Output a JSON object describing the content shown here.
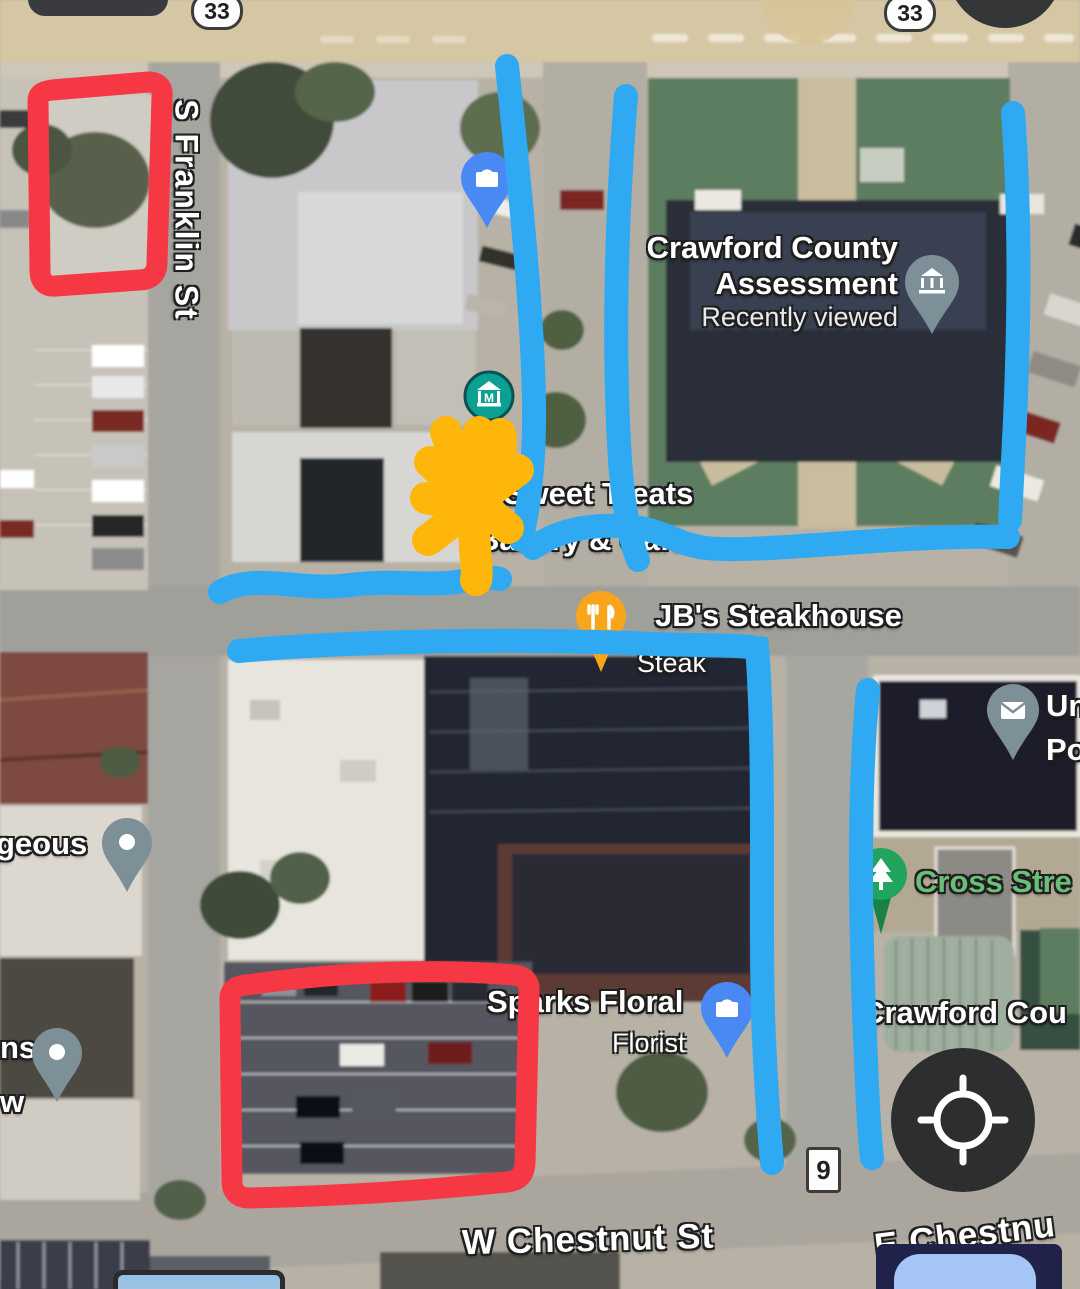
{
  "map_type": "satellite",
  "streets": {
    "franklin": "S Franklin St",
    "west_chestnut": "W Chestnut St",
    "east_chestnut": "E Chestnu"
  },
  "route_shields": {
    "left": "33",
    "right": "33",
    "bottom": "9"
  },
  "places": {
    "assessment": {
      "name_line1": "Crawford County",
      "name_line2": "Assessment",
      "status": "Recently viewed",
      "icon": "government-pin"
    },
    "bakery": {
      "name_line1": "ty's Sweet Treats",
      "name_line2": "Bakery & Cafe",
      "icon": "museum-pin"
    },
    "steakhouse": {
      "name": "JB's Steakhouse",
      "category": "Steak",
      "icon": "restaurant-pin"
    },
    "floral": {
      "name": "Sparks Floral",
      "category": "Florist",
      "icon": "shopping-bag-pin"
    },
    "cross_street": {
      "name": "Cross Stre",
      "icon": "tree-pin"
    },
    "crawford_partial": {
      "name": "Crawford Cou"
    },
    "post_office": {
      "name_line1": "Un",
      "name_line2": "Po",
      "icon": "mail-pin"
    },
    "gorgeous_partial": {
      "name": "geous",
      "icon": "place-pin"
    },
    "ns_partial": {
      "name_line1": "ns",
      "name_line2": "w",
      "icon": "place-pin"
    }
  },
  "annotations": {
    "red_boxes": 2,
    "blue_strokes": 7,
    "orange_scribbles": 1,
    "red_color": "#f63744",
    "blue_color": "#2ea9f2",
    "orange_color": "#ffb60a"
  },
  "colors": {
    "poi_blue": "#4a89f4",
    "museum_teal": "#0ba192",
    "slate_pin": "#7e9097",
    "restaurant_orange": "#f8a51b",
    "park_green": "#21a45d",
    "park_label_green": "#6abf77"
  },
  "controls": {
    "locate_icon": "gps-crosshair"
  }
}
